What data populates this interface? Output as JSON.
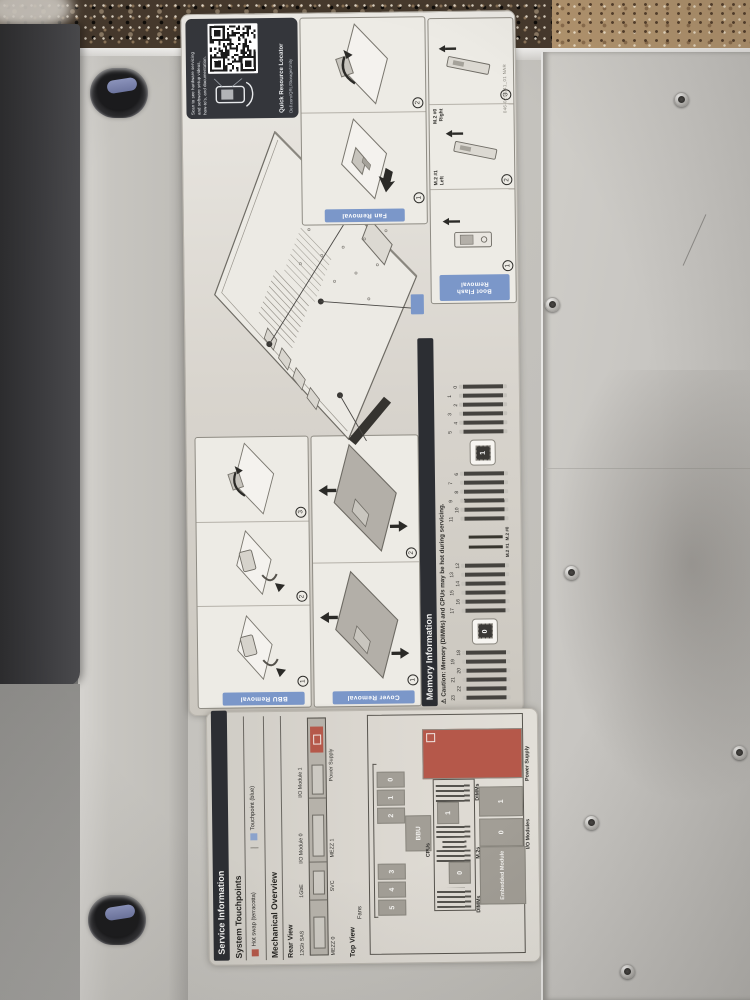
{
  "colors": {
    "accent_blue": "#7b97c9",
    "terracotta": "#b5584a",
    "touchpoint_blue": "#8ba3cc",
    "dark_bar": "#2c2e33"
  },
  "qr": {
    "line1": "Scan to see hardware servicing",
    "line2": "and software setup videos,",
    "line3": "how-to's, and documentation.",
    "title": "Quick Resource Locator",
    "url": "Dell.com/QRL/Storage/Unity"
  },
  "part_number": "046-026-041_01 NAR",
  "removal": {
    "fan": {
      "tab": "Fan Removal",
      "steps": [
        "1",
        "2"
      ]
    },
    "bbu": {
      "tab": "BBU Removal",
      "steps": [
        "1",
        "2",
        "3"
      ]
    },
    "cover": {
      "tab": "Cover Removal",
      "steps": [
        "1",
        "2"
      ]
    },
    "boot": {
      "tab_line1": "Boot Flash",
      "tab_line2": "Removal",
      "steps": [
        "1",
        "2",
        "3"
      ],
      "m2_1": "M.2 #1",
      "m2_1_side": "Left",
      "m2_0": "M.2 #0",
      "m2_0_side": "Right"
    }
  },
  "memory": {
    "header": "Memory Information",
    "caution_icon": "⚠",
    "caution": "Caution: Memory (DIMMs) and CPUs may be hot during servicing.",
    "dimm_groups": [
      [
        "23",
        "22",
        "21",
        "20",
        "19",
        "18"
      ],
      [
        "17",
        "16",
        "15",
        "14",
        "13",
        "12"
      ],
      [
        "11",
        "10",
        "9",
        "8",
        "7",
        "6"
      ],
      [
        "5",
        "4",
        "3",
        "2",
        "1",
        "0"
      ]
    ],
    "cpu_left": "0",
    "cpu_right": "1",
    "m2_left": "M.2 #1",
    "m2_right": "M.2 #0"
  },
  "service": {
    "title": "Service Information",
    "touchpoints": "System Touchpoints",
    "legend_hot": "Hot swap (terracotta)",
    "legend_touch": "Touchpoint (blue)",
    "mechanical": "Mechanical Overview",
    "rear": "Rear View",
    "rear_top": [
      "12Gb SAS",
      "1GbE",
      "I/O Module 0",
      "I/O Module 1"
    ],
    "rear_bottom": [
      "MEZZ 0",
      "SVC",
      "MEZZ 1",
      "Power Supply"
    ],
    "top": "Top View",
    "fans": "Fans",
    "fan_rows": [
      [
        "5",
        "4",
        "3"
      ],
      [
        "2",
        "1",
        "0"
      ]
    ],
    "bbu": "BBU",
    "cpus": "CPUs",
    "cpu0": "0",
    "cpu1": "1",
    "dimms_left": "DIMMs",
    "m2s": "M.2s",
    "dimms_right": "DIMMs",
    "embedded": "Embedded Module",
    "io0": "0",
    "io1": "1",
    "io_label": "I/O Modules",
    "psu_label": "Power Supply"
  }
}
